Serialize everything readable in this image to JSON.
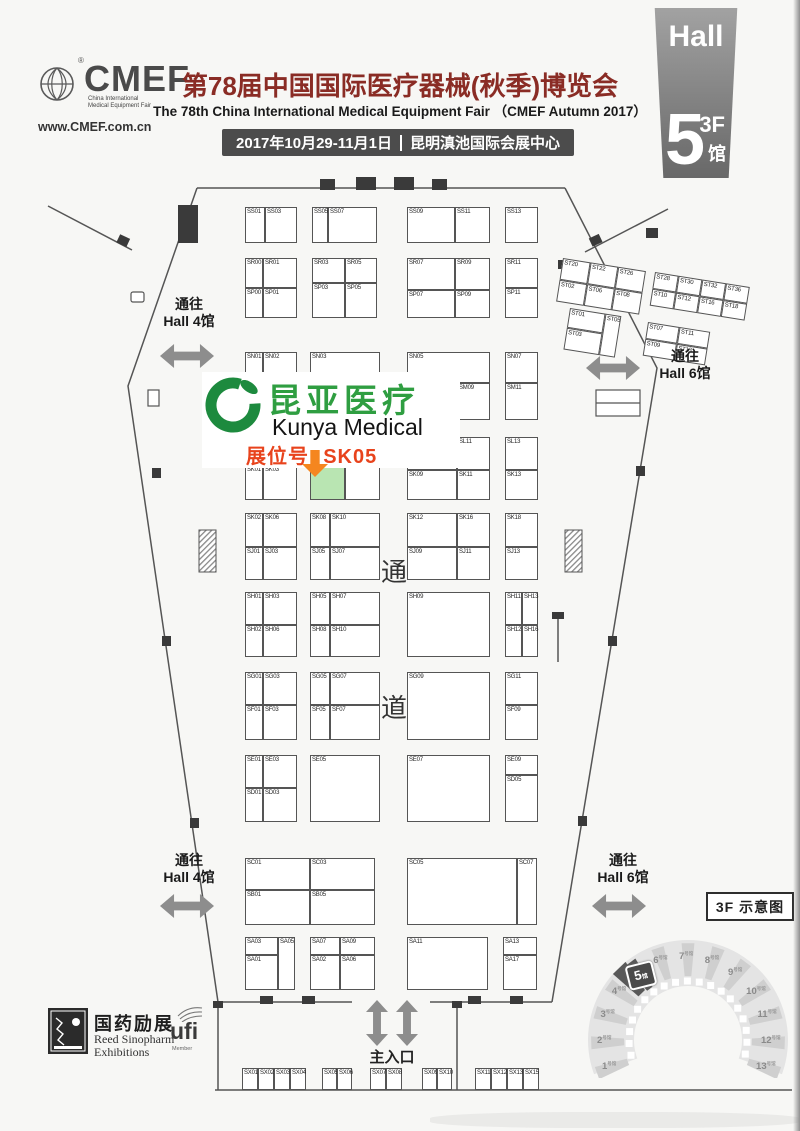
{
  "header": {
    "logo": {
      "brand": "CMEF",
      "registered": "®",
      "tagline1": "China International",
      "tagline2": "Medical Equipment Fair",
      "website": "www.CMEF.com.cn"
    },
    "title_cn": "第78届中国国际医疗器械(秋季)博览会",
    "title_en": "The 78th China International Medical Equipment Fair （CMEF Autumn 2017）",
    "date": "2017年10月29-11月1日",
    "venue": "昆明滇池国际会展中心",
    "hall_badge": {
      "hall_label": "Hall",
      "number": "5",
      "floor": "3F",
      "suffix": "馆"
    }
  },
  "exhibitor": {
    "name_cn": "昆亚医疗",
    "name_en": "Kunya Medical",
    "booth_label": "展位号: SK05",
    "booth_id": "SK05",
    "colors": {
      "green": "#2f9e41",
      "orange": "#f5861f",
      "red": "#e8431c",
      "highlight": "#b9e5b2"
    }
  },
  "directions": {
    "to_hall4": {
      "line1": "通往",
      "line2": "Hall 4馆"
    },
    "to_hall6": {
      "line1": "通往",
      "line2": "Hall 6馆"
    },
    "main_entrance": "主入口",
    "aisle_char1": "通",
    "aisle_char2": "道"
  },
  "footer": {
    "organizer_cn": "国药励展",
    "organizer_en1": "Reed Sinopharm",
    "organizer_en2": "Exhibitions",
    "ufi": "ufi",
    "ufi_member": "Member"
  },
  "overview": {
    "title": "3F 示意图",
    "halls": [
      "1",
      "2",
      "3",
      "4",
      "5",
      "6",
      "7",
      "8",
      "9",
      "10",
      "11",
      "12",
      "13"
    ],
    "hall_suffix": "号馆",
    "highlight_index": 4,
    "highlight_number": "5",
    "highlight_suffix": "馆"
  },
  "map": {
    "booths": [
      {
        "id": "SS01",
        "x": 245,
        "y": 207,
        "w": 20,
        "h": 36
      },
      {
        "id": "SS03",
        "x": 265,
        "y": 207,
        "w": 32,
        "h": 36
      },
      {
        "id": "SS05",
        "x": 312,
        "y": 207,
        "w": 16,
        "h": 36
      },
      {
        "id": "SS07",
        "x": 328,
        "y": 207,
        "w": 49,
        "h": 36
      },
      {
        "id": "SS09",
        "x": 407,
        "y": 207,
        "w": 48,
        "h": 36
      },
      {
        "id": "SS11",
        "x": 455,
        "y": 207,
        "w": 35,
        "h": 36
      },
      {
        "id": "SS13",
        "x": 505,
        "y": 207,
        "w": 33,
        "h": 36
      },
      {
        "id": "SR00",
        "x": 245,
        "y": 258,
        "w": 18,
        "h": 30
      },
      {
        "id": "SR01",
        "x": 263,
        "y": 258,
        "w": 34,
        "h": 30
      },
      {
        "id": "SP00",
        "x": 245,
        "y": 288,
        "w": 18,
        "h": 30
      },
      {
        "id": "SP01",
        "x": 263,
        "y": 288,
        "w": 34,
        "h": 30
      },
      {
        "id": "SR03",
        "x": 312,
        "y": 258,
        "w": 33,
        "h": 25
      },
      {
        "id": "SR05",
        "x": 345,
        "y": 258,
        "w": 32,
        "h": 25
      },
      {
        "id": "SP03",
        "x": 312,
        "y": 283,
        "w": 33,
        "h": 35
      },
      {
        "id": "SP05",
        "x": 345,
        "y": 283,
        "w": 32,
        "h": 35
      },
      {
        "id": "SR07",
        "x": 407,
        "y": 258,
        "w": 48,
        "h": 32
      },
      {
        "id": "SR09",
        "x": 455,
        "y": 258,
        "w": 35,
        "h": 32
      },
      {
        "id": "SP07",
        "x": 407,
        "y": 290,
        "w": 48,
        "h": 28
      },
      {
        "id": "SP09",
        "x": 455,
        "y": 290,
        "w": 35,
        "h": 28
      },
      {
        "id": "SR11",
        "x": 505,
        "y": 258,
        "w": 33,
        "h": 30
      },
      {
        "id": "SP11",
        "x": 505,
        "y": 288,
        "w": 33,
        "h": 30
      },
      {
        "id": "SN01",
        "x": 245,
        "y": 352,
        "w": 18,
        "h": 68
      },
      {
        "id": "SN02",
        "x": 263,
        "y": 352,
        "w": 34,
        "h": 68
      },
      {
        "id": "SN03",
        "x": 310,
        "y": 352,
        "w": 70,
        "h": 68
      },
      {
        "id": "SN05",
        "x": 407,
        "y": 352,
        "w": 83,
        "h": 31
      },
      {
        "id": "SM07",
        "x": 407,
        "y": 383,
        "w": 50,
        "h": 37
      },
      {
        "id": "SM09",
        "x": 457,
        "y": 383,
        "w": 33,
        "h": 37
      },
      {
        "id": "SN07",
        "x": 505,
        "y": 352,
        "w": 33,
        "h": 31
      },
      {
        "id": "SM11",
        "x": 505,
        "y": 383,
        "w": 33,
        "h": 37
      },
      {
        "id": "SL09",
        "x": 407,
        "y": 437,
        "w": 50,
        "h": 33
      },
      {
        "id": "SL11",
        "x": 457,
        "y": 437,
        "w": 33,
        "h": 33
      },
      {
        "id": "SK09",
        "x": 407,
        "y": 470,
        "w": 50,
        "h": 30
      },
      {
        "id": "SK11",
        "x": 457,
        "y": 470,
        "w": 33,
        "h": 30
      },
      {
        "id": "SL13",
        "x": 505,
        "y": 437,
        "w": 33,
        "h": 33
      },
      {
        "id": "SK13",
        "x": 505,
        "y": 470,
        "w": 33,
        "h": 30
      },
      {
        "id": "SK01",
        "x": 245,
        "y": 465,
        "w": 18,
        "h": 35
      },
      {
        "id": "SK03",
        "x": 263,
        "y": 465,
        "w": 34,
        "h": 35
      },
      {
        "id": "SK05",
        "x": 310,
        "y": 462,
        "w": 35,
        "h": 38,
        "hl": true
      },
      {
        "id": "SK07",
        "x": 345,
        "y": 462,
        "w": 35,
        "h": 38
      },
      {
        "id": "SK02",
        "x": 245,
        "y": 513,
        "w": 18,
        "h": 34
      },
      {
        "id": "SK06",
        "x": 263,
        "y": 513,
        "w": 34,
        "h": 34
      },
      {
        "id": "SJ01",
        "x": 245,
        "y": 547,
        "w": 18,
        "h": 33
      },
      {
        "id": "SJ03",
        "x": 263,
        "y": 547,
        "w": 34,
        "h": 33
      },
      {
        "id": "SK08",
        "x": 310,
        "y": 513,
        "w": 20,
        "h": 34
      },
      {
        "id": "SK10",
        "x": 330,
        "y": 513,
        "w": 50,
        "h": 34
      },
      {
        "id": "SJ05",
        "x": 310,
        "y": 547,
        "w": 20,
        "h": 33
      },
      {
        "id": "SJ07",
        "x": 330,
        "y": 547,
        "w": 50,
        "h": 33
      },
      {
        "id": "SK12",
        "x": 407,
        "y": 513,
        "w": 50,
        "h": 34
      },
      {
        "id": "SK16",
        "x": 457,
        "y": 513,
        "w": 33,
        "h": 34
      },
      {
        "id": "SJ09",
        "x": 407,
        "y": 547,
        "w": 50,
        "h": 33
      },
      {
        "id": "SJ11",
        "x": 457,
        "y": 547,
        "w": 33,
        "h": 33
      },
      {
        "id": "SK18",
        "x": 505,
        "y": 513,
        "w": 33,
        "h": 34
      },
      {
        "id": "SJ13",
        "x": 505,
        "y": 547,
        "w": 33,
        "h": 33
      },
      {
        "id": "SH01",
        "x": 245,
        "y": 592,
        "w": 18,
        "h": 33
      },
      {
        "id": "SH03",
        "x": 263,
        "y": 592,
        "w": 34,
        "h": 33
      },
      {
        "id": "SH02",
        "x": 245,
        "y": 625,
        "w": 18,
        "h": 32
      },
      {
        "id": "SH06",
        "x": 263,
        "y": 625,
        "w": 34,
        "h": 32
      },
      {
        "id": "SH05",
        "x": 310,
        "y": 592,
        "w": 20,
        "h": 33
      },
      {
        "id": "SH07",
        "x": 330,
        "y": 592,
        "w": 50,
        "h": 33
      },
      {
        "id": "SH08",
        "x": 310,
        "y": 625,
        "w": 20,
        "h": 32
      },
      {
        "id": "SH10",
        "x": 330,
        "y": 625,
        "w": 50,
        "h": 32
      },
      {
        "id": "SH09",
        "x": 407,
        "y": 592,
        "w": 83,
        "h": 65
      },
      {
        "id": "SH11",
        "x": 505,
        "y": 592,
        "w": 17,
        "h": 33
      },
      {
        "id": "SH13",
        "x": 522,
        "y": 592,
        "w": 16,
        "h": 33
      },
      {
        "id": "SH12",
        "x": 505,
        "y": 625,
        "w": 17,
        "h": 32
      },
      {
        "id": "SH16",
        "x": 522,
        "y": 625,
        "w": 16,
        "h": 32
      },
      {
        "id": "SG01",
        "x": 245,
        "y": 672,
        "w": 18,
        "h": 33
      },
      {
        "id": "SG03",
        "x": 263,
        "y": 672,
        "w": 34,
        "h": 33
      },
      {
        "id": "SF01",
        "x": 245,
        "y": 705,
        "w": 18,
        "h": 35
      },
      {
        "id": "SF03",
        "x": 263,
        "y": 705,
        "w": 34,
        "h": 35
      },
      {
        "id": "SG05",
        "x": 310,
        "y": 672,
        "w": 20,
        "h": 33
      },
      {
        "id": "SG07",
        "x": 330,
        "y": 672,
        "w": 50,
        "h": 33
      },
      {
        "id": "SF05",
        "x": 310,
        "y": 705,
        "w": 20,
        "h": 35
      },
      {
        "id": "SF07",
        "x": 330,
        "y": 705,
        "w": 50,
        "h": 35
      },
      {
        "id": "SG09",
        "x": 407,
        "y": 672,
        "w": 83,
        "h": 68
      },
      {
        "id": "SG11",
        "x": 505,
        "y": 672,
        "w": 33,
        "h": 33
      },
      {
        "id": "SF09",
        "x": 505,
        "y": 705,
        "w": 33,
        "h": 35
      },
      {
        "id": "SE01",
        "x": 245,
        "y": 755,
        "w": 18,
        "h": 33
      },
      {
        "id": "SE03",
        "x": 263,
        "y": 755,
        "w": 34,
        "h": 33
      },
      {
        "id": "SD01",
        "x": 245,
        "y": 788,
        "w": 18,
        "h": 34
      },
      {
        "id": "SD03",
        "x": 263,
        "y": 788,
        "w": 34,
        "h": 34
      },
      {
        "id": "SE05",
        "x": 310,
        "y": 755,
        "w": 70,
        "h": 67
      },
      {
        "id": "SE07",
        "x": 407,
        "y": 755,
        "w": 83,
        "h": 67
      },
      {
        "id": "SE09",
        "x": 505,
        "y": 755,
        "w": 33,
        "h": 20
      },
      {
        "id": "SD05",
        "x": 505,
        "y": 775,
        "w": 33,
        "h": 47
      },
      {
        "id": "SC01",
        "x": 245,
        "y": 858,
        "w": 65,
        "h": 32
      },
      {
        "id": "SC03",
        "x": 310,
        "y": 858,
        "w": 65,
        "h": 32
      },
      {
        "id": "SB01",
        "x": 245,
        "y": 890,
        "w": 65,
        "h": 35
      },
      {
        "id": "SB05",
        "x": 310,
        "y": 890,
        "w": 65,
        "h": 35
      },
      {
        "id": "SC05",
        "x": 407,
        "y": 858,
        "w": 110,
        "h": 67
      },
      {
        "id": "SC07",
        "x": 517,
        "y": 858,
        "w": 20,
        "h": 67
      },
      {
        "id": "SA03",
        "x": 245,
        "y": 937,
        "w": 33,
        "h": 18
      },
      {
        "id": "SA01",
        "x": 245,
        "y": 955,
        "w": 33,
        "h": 35
      },
      {
        "id": "SA05",
        "x": 278,
        "y": 937,
        "w": 17,
        "h": 53
      },
      {
        "id": "SA07",
        "x": 310,
        "y": 937,
        "w": 30,
        "h": 18
      },
      {
        "id": "SA09",
        "x": 340,
        "y": 937,
        "w": 35,
        "h": 18
      },
      {
        "id": "SA02",
        "x": 310,
        "y": 955,
        "w": 30,
        "h": 35
      },
      {
        "id": "SA06",
        "x": 340,
        "y": 955,
        "w": 35,
        "h": 35
      },
      {
        "id": "SA11",
        "x": 407,
        "y": 937,
        "w": 81,
        "h": 53
      },
      {
        "id": "SA13",
        "x": 503,
        "y": 937,
        "w": 34,
        "h": 18
      },
      {
        "id": "SA17",
        "x": 503,
        "y": 955,
        "w": 34,
        "h": 35
      },
      {
        "id": "SX01",
        "x": 242,
        "y": 1068,
        "w": 16,
        "h": 22
      },
      {
        "id": "SX02",
        "x": 258,
        "y": 1068,
        "w": 16,
        "h": 22
      },
      {
        "id": "SX03",
        "x": 274,
        "y": 1068,
        "w": 16,
        "h": 22
      },
      {
        "id": "SX04",
        "x": 290,
        "y": 1068,
        "w": 16,
        "h": 22
      },
      {
        "id": "SX05",
        "x": 322,
        "y": 1068,
        "w": 15,
        "h": 22
      },
      {
        "id": "SX06",
        "x": 337,
        "y": 1068,
        "w": 15,
        "h": 22
      },
      {
        "id": "SX07",
        "x": 370,
        "y": 1068,
        "w": 16,
        "h": 22
      },
      {
        "id": "SX08",
        "x": 386,
        "y": 1068,
        "w": 16,
        "h": 22
      },
      {
        "id": "SX09",
        "x": 422,
        "y": 1068,
        "w": 15,
        "h": 22
      },
      {
        "id": "SX10",
        "x": 437,
        "y": 1068,
        "w": 15,
        "h": 22
      },
      {
        "id": "SX11",
        "x": 475,
        "y": 1068,
        "w": 16,
        "h": 22
      },
      {
        "id": "SX12",
        "x": 491,
        "y": 1068,
        "w": 16,
        "h": 22
      },
      {
        "id": "SX13",
        "x": 507,
        "y": 1068,
        "w": 16,
        "h": 22
      },
      {
        "id": "SX15",
        "x": 523,
        "y": 1068,
        "w": 16,
        "h": 22
      }
    ],
    "st_blocks": [
      {
        "x": 563,
        "y": 258,
        "rot": 9,
        "cells": [
          {
            "id": "ST20",
            "x": 0,
            "y": 0,
            "w": 28,
            "h": 22
          },
          {
            "id": "ST22",
            "x": 28,
            "y": 0,
            "w": 28,
            "h": 22
          },
          {
            "id": "ST26",
            "x": 56,
            "y": 0,
            "w": 28,
            "h": 22
          },
          {
            "id": "ST02",
            "x": 0,
            "y": 22,
            "w": 28,
            "h": 22
          },
          {
            "id": "ST06",
            "x": 28,
            "y": 22,
            "w": 28,
            "h": 22
          },
          {
            "id": "ST08",
            "x": 56,
            "y": 22,
            "w": 28,
            "h": 22
          }
        ]
      },
      {
        "x": 655,
        "y": 272,
        "rot": 9,
        "cells": [
          {
            "id": "ST28",
            "x": 0,
            "y": 0,
            "w": 24,
            "h": 17
          },
          {
            "id": "ST30",
            "x": 24,
            "y": 0,
            "w": 24,
            "h": 17
          },
          {
            "id": "ST32",
            "x": 48,
            "y": 0,
            "w": 24,
            "h": 17
          },
          {
            "id": "ST36",
            "x": 72,
            "y": 0,
            "w": 24,
            "h": 17
          },
          {
            "id": "ST10",
            "x": 0,
            "y": 17,
            "w": 24,
            "h": 17
          },
          {
            "id": "ST12",
            "x": 24,
            "y": 17,
            "w": 24,
            "h": 17
          },
          {
            "id": "ST16",
            "x": 48,
            "y": 17,
            "w": 24,
            "h": 17
          },
          {
            "id": "ST18",
            "x": 72,
            "y": 17,
            "w": 24,
            "h": 17
          }
        ]
      },
      {
        "x": 570,
        "y": 308,
        "rot": 9,
        "cells": [
          {
            "id": "ST01",
            "x": 0,
            "y": 0,
            "w": 36,
            "h": 20
          },
          {
            "id": "ST05",
            "x": 36,
            "y": 0,
            "w": 16,
            "h": 42
          },
          {
            "id": "ST03",
            "x": 0,
            "y": 20,
            "w": 36,
            "h": 22
          }
        ]
      },
      {
        "x": 648,
        "y": 322,
        "rot": 9,
        "cells": [
          {
            "id": "ST07",
            "x": 0,
            "y": 0,
            "w": 32,
            "h": 17
          },
          {
            "id": "ST11",
            "x": 32,
            "y": 0,
            "w": 31,
            "h": 17
          },
          {
            "id": "ST09",
            "x": 0,
            "y": 17,
            "w": 32,
            "h": 17
          },
          {
            "id": "ST13",
            "x": 32,
            "y": 17,
            "w": 31,
            "h": 17
          }
        ]
      }
    ]
  }
}
